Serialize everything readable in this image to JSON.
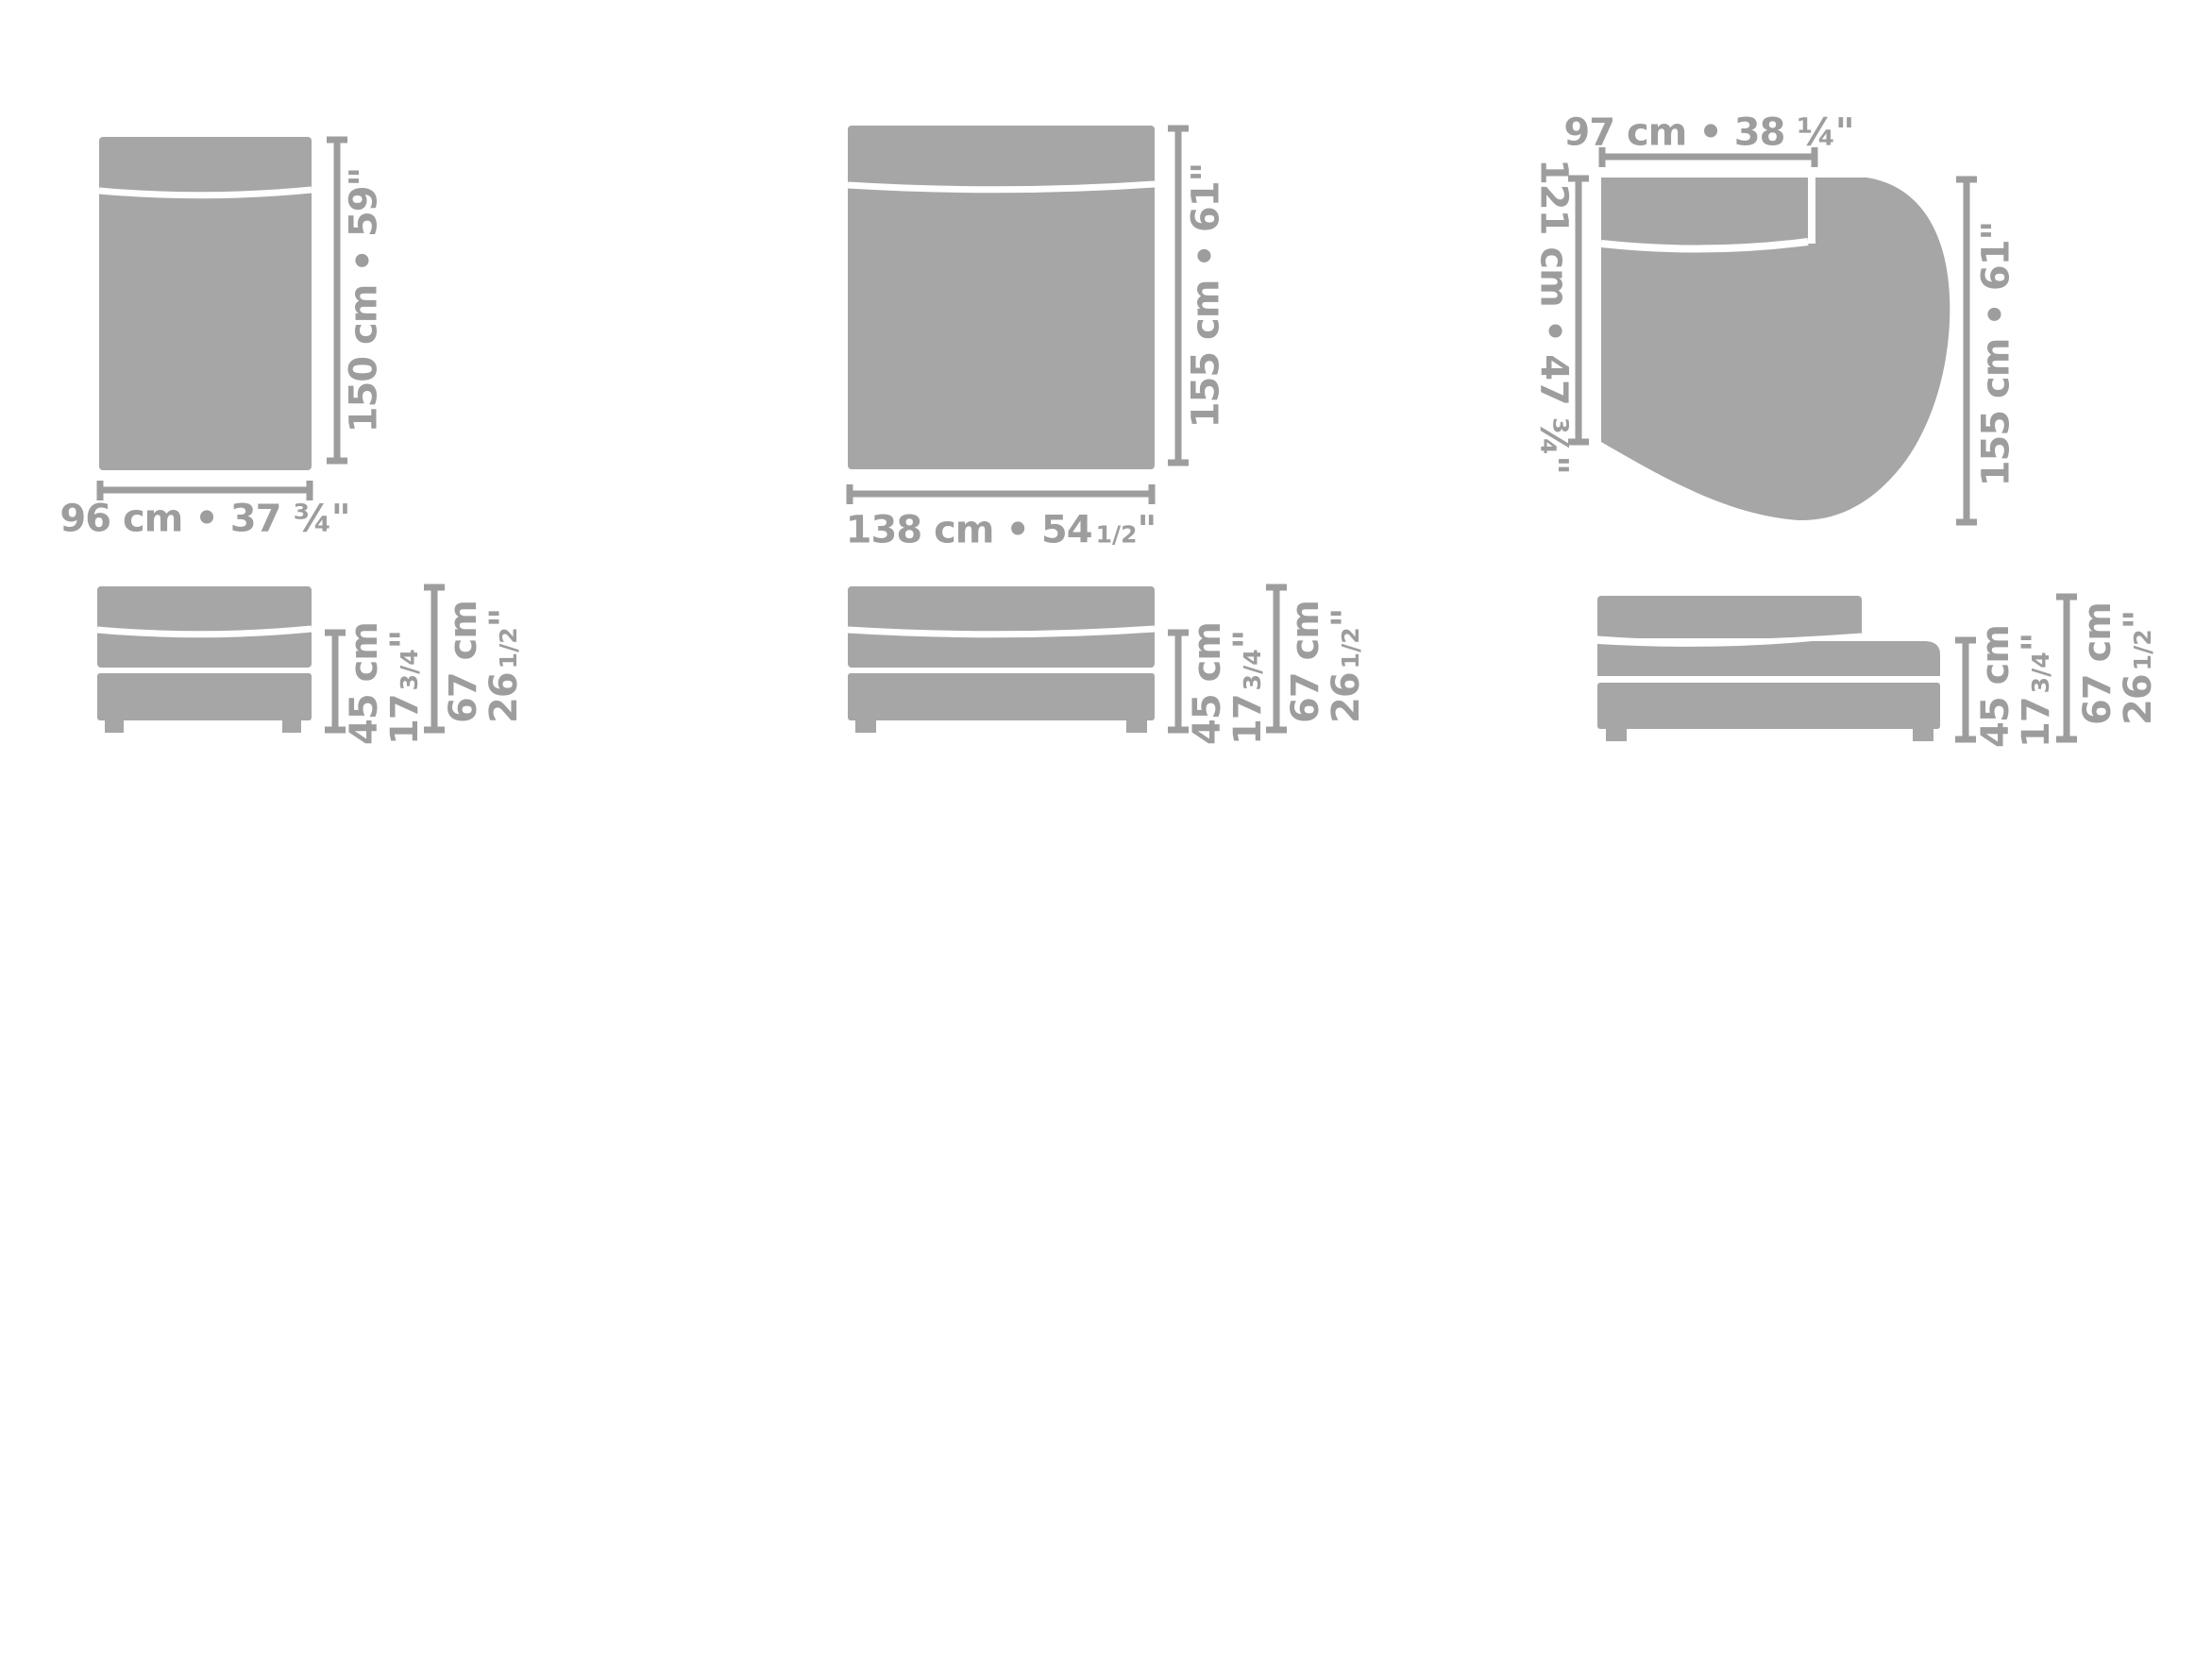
{
  "palette": {
    "background": "#ffffff",
    "shape": "#a6a6a6",
    "dim": "#9d9d9d"
  },
  "modules": {
    "module_96": {
      "top_view": {
        "width_label": "96 cm • 37 ¾\"",
        "height_label": "150 cm • 59\""
      }
    },
    "module_138": {
      "top_view": {
        "width_label_main": "138 cm • 54",
        "width_label_fraction": "1/2",
        "width_label_unit": "\"",
        "height_label": "155 cm • 61\""
      }
    },
    "module_round": {
      "top_view": {
        "backrest_width_label": "97 cm • 38 ¼\"",
        "depth_label": "121 cm • 47 ¾\"",
        "length_label": "155 cm • 61\""
      }
    },
    "front_view_dims": {
      "seat_height_cm": "45 cm",
      "seat_height_in_main": "17",
      "seat_height_in_fraction": "3/4",
      "seat_height_in_unit": "\"",
      "total_height_cm": "67 cm",
      "total_height_in_main": "26",
      "total_height_in_fraction": "1/2",
      "total_height_in_unit": "\""
    }
  }
}
